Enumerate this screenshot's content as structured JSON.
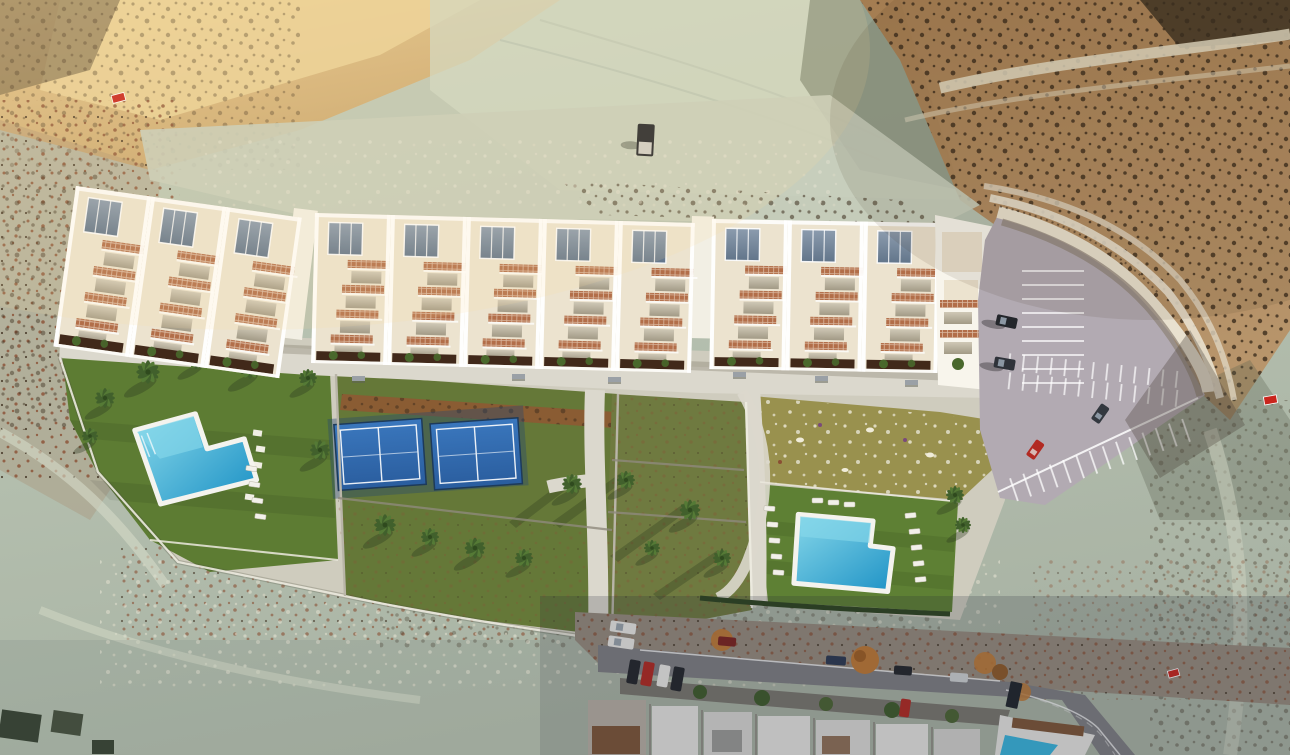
{
  "meta": {
    "title": "Aerial drone render of a new hillside townhouse development with gardens, two pools, padel courts and parking, surrounded by desert badlands and an existing street below",
    "type": "architectural-aerial-render",
    "visible_text": []
  },
  "scene": {
    "development": {
      "building_bands": 3,
      "townhouse_units": 12,
      "community_block": 1,
      "pools": 2,
      "padel_courts": 2,
      "amenities": [
        "promenade-walkway",
        "left-garden-pool",
        "padel-courts",
        "scrub-garden-plots",
        "wildflower-meadow",
        "right-garden-pool",
        "parking-lot",
        "retaining-wall"
      ]
    },
    "surroundings": [
      "desert-badlands",
      "sunlit-ridge",
      "dirt-track",
      "existing-street",
      "existing-house-row",
      "villa-with-pool",
      "curved-road"
    ],
    "vehicles": {
      "parking_lot": 4,
      "street": 10,
      "dirt_track_pickup": 1
    },
    "signs": {
      "for_sale_markers": 3
    },
    "colors": {
      "terrainBase": "#b7c2b2",
      "terrainLight": "#cfd8c6",
      "sunTan": "#e8c98e",
      "sunTanDeep": "#c9a369",
      "hillBrown": "#a57b4e",
      "scrubDark": "#3c2d1d",
      "scrubRust": "#8a4f33",
      "canyonShadow": "#5d6a55",
      "roofCream": "#ece3cf",
      "wallWhite": "#f8f5ec",
      "glazing": "#7e8ea0",
      "terracotta": "#b26e49",
      "planter": "#41291a",
      "bushGreen": "#49682c",
      "lawnGreen": "#5d7c33",
      "scrubLawn": "#6f7a40",
      "meadow": "#99914e",
      "mulch": "#8a5c33",
      "pathLight": "#dbd8cd",
      "poolLight": "#86d7e9",
      "poolDeep": "#1f93c6",
      "courtBlue": "#2f6cb3",
      "parkAsphalt": "#b2aab2",
      "wallCream": "#e9e1cf",
      "slopeShade": "#8d8276",
      "streetGrey": "#7f7f82",
      "dirtStrip": "#968b7d",
      "houseWhite": "#e6e5e2",
      "roofBrown": "#7d5638",
      "carRed": "#b22a22",
      "carWhite": "#eceae6",
      "carDark": "#23262b",
      "carNavy": "#2c3952",
      "treeOrange": "#c07a35",
      "treeGreen": "#3f5c2b",
      "signRed": "#c9251d"
    }
  }
}
